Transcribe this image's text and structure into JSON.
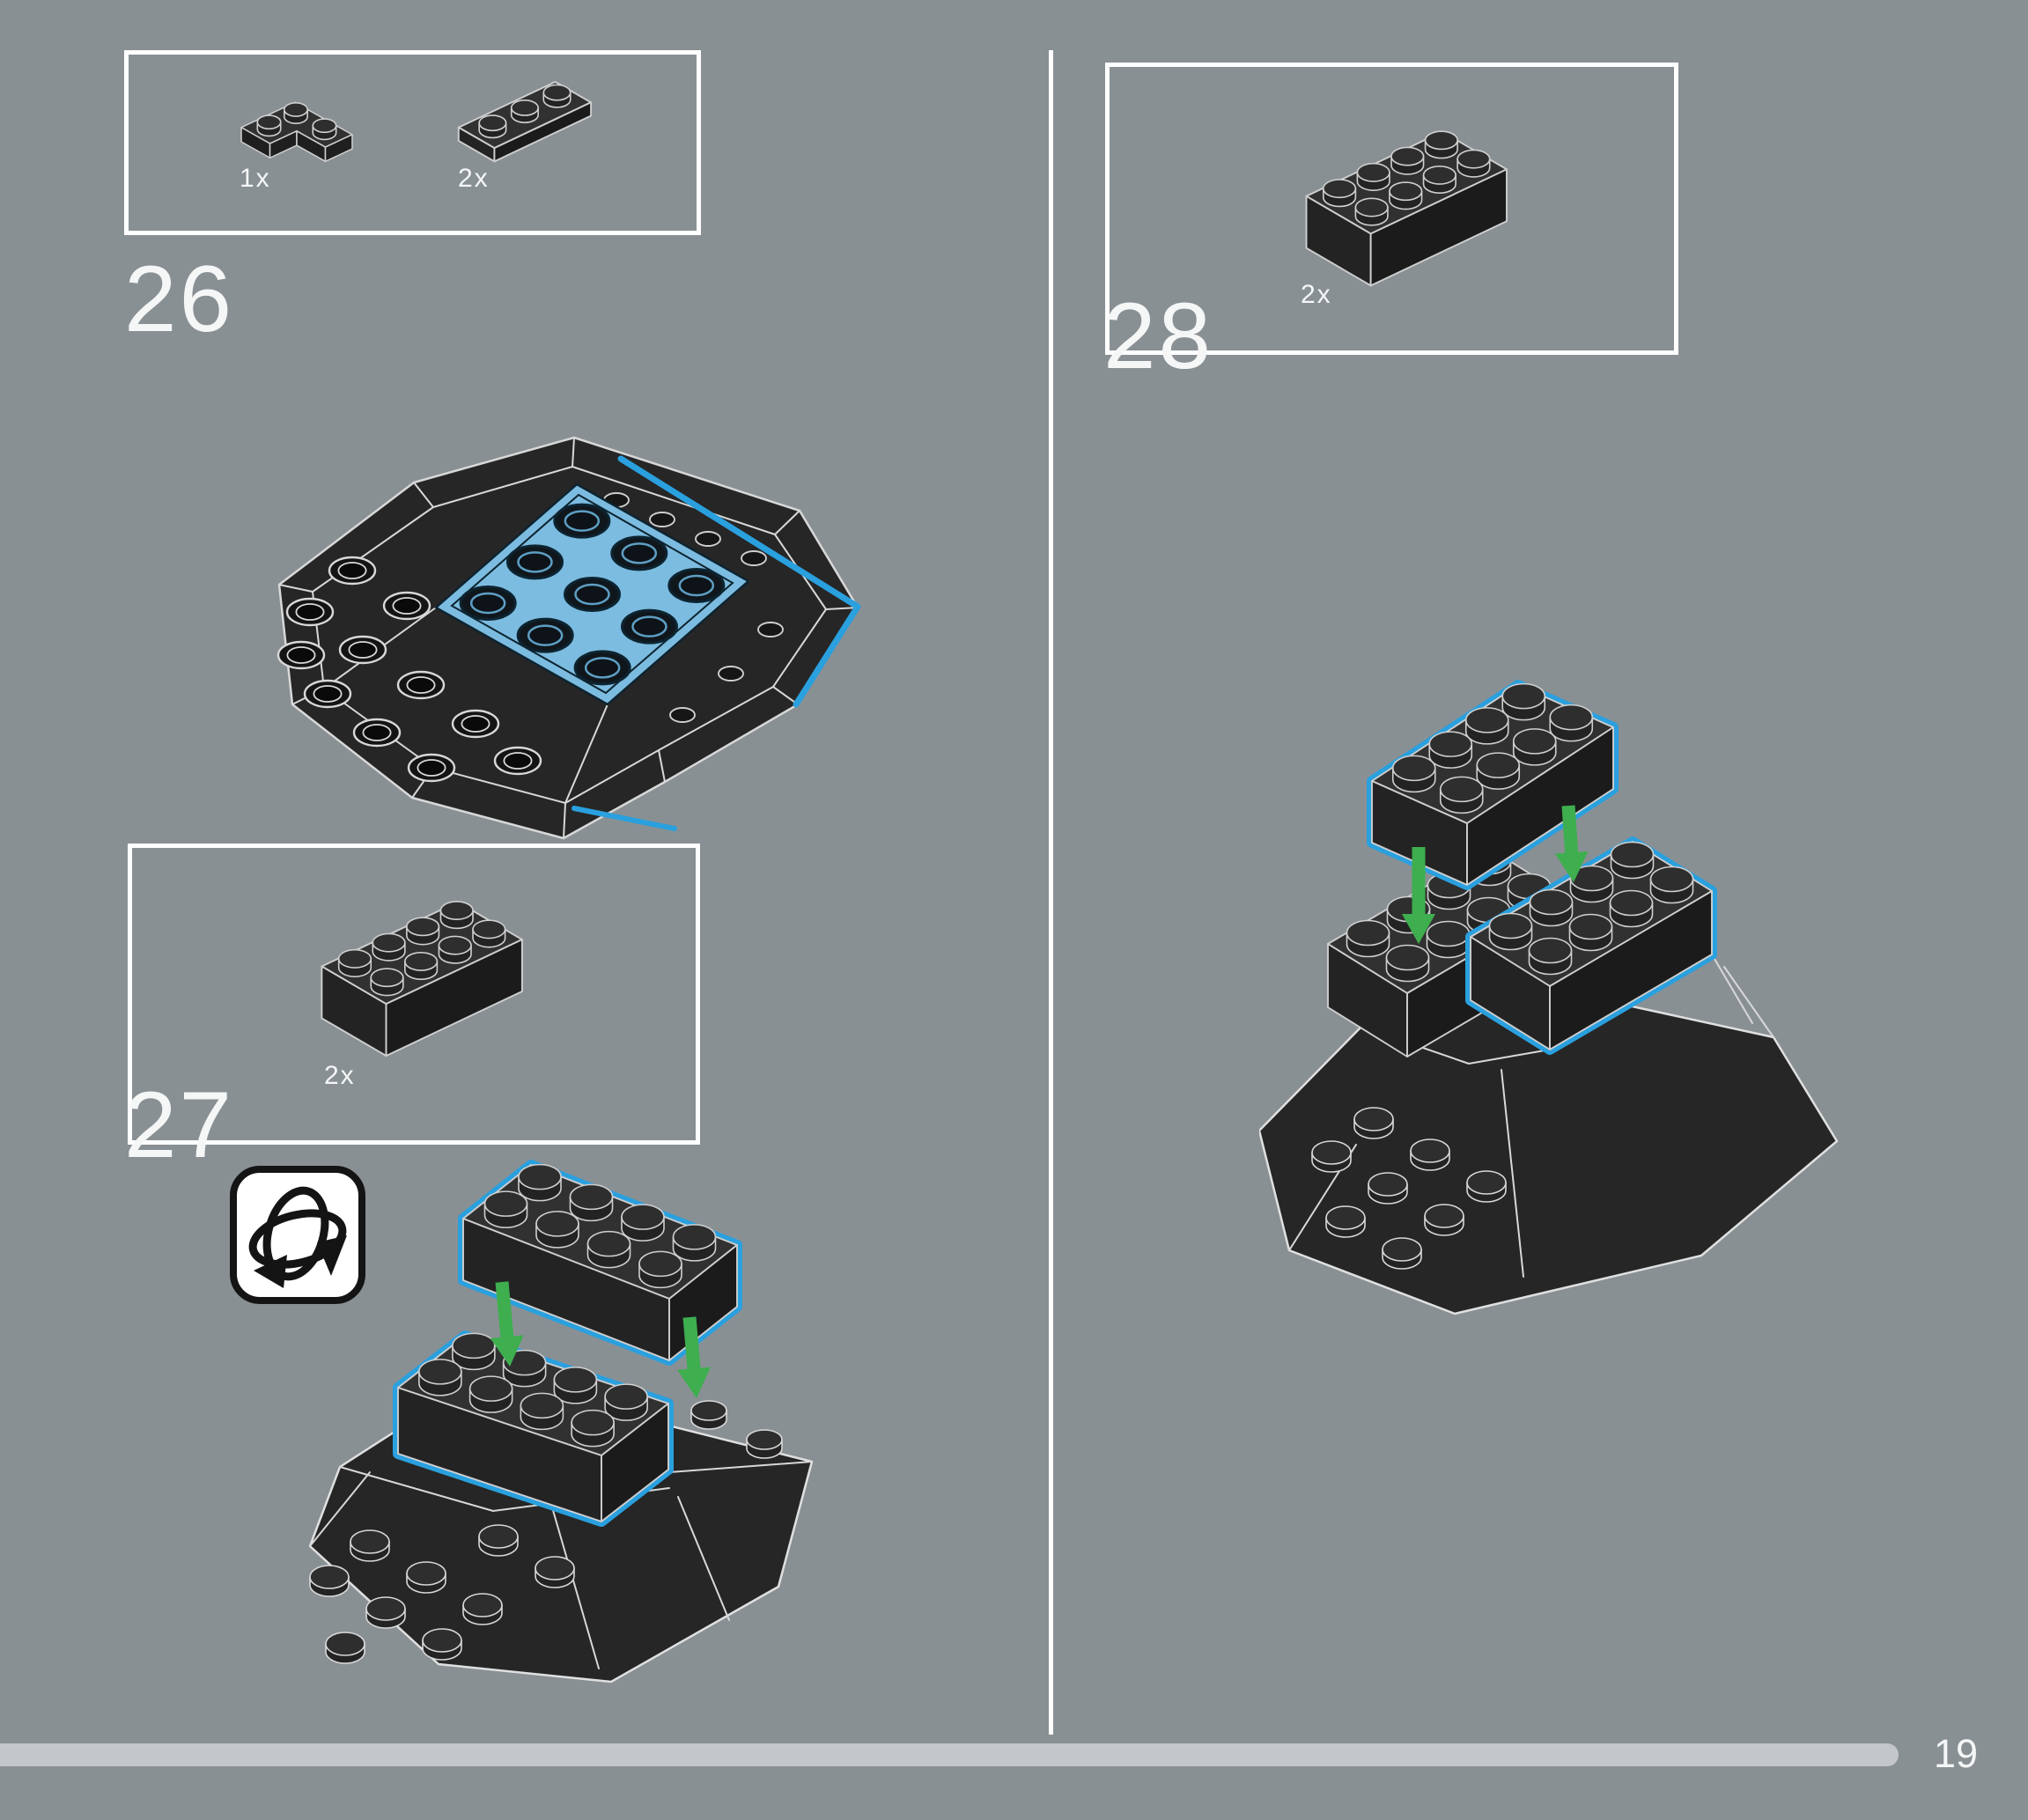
{
  "page": {
    "title": "LEGO building instructions page",
    "colors": {
      "background": "#899094",
      "outline_white": "#ffffff",
      "brick_dark": "#262626",
      "highlight_blue": "#2aa0de",
      "plate_blue_fill": "#7cbce0",
      "arrow_green": "#3eae4f",
      "progress_bar": "#c3c7c9"
    }
  },
  "steps": {
    "step26": {
      "number": "26",
      "parts": [
        {
          "id": "plate-2x2-corner",
          "count": "1x"
        },
        {
          "id": "plate-1x3",
          "count": "2x"
        }
      ]
    },
    "step27": {
      "number": "27",
      "parts": [
        {
          "id": "brick-2x4",
          "count": "2x"
        }
      ],
      "rotate_icon": "rotate-model-icon"
    },
    "step28": {
      "number": "28",
      "parts": [
        {
          "id": "brick-2x4",
          "count": "2x"
        }
      ]
    }
  },
  "footer": {
    "page_number": "19",
    "progress_percent": 93.6
  }
}
